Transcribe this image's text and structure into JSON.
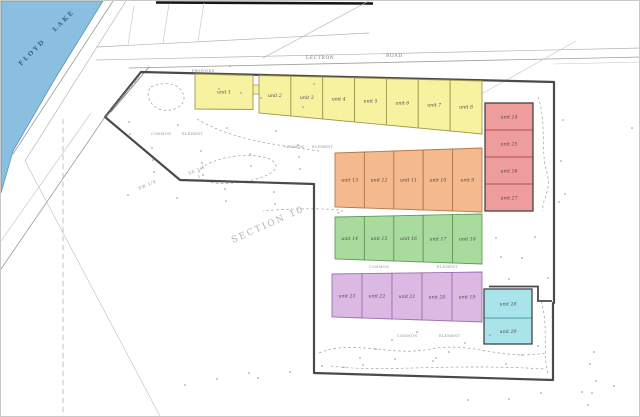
{
  "drawing": {
    "lake": {
      "label": "FLOYD LAKE",
      "color": "#8abfe0"
    },
    "roads": {
      "lectron": "LECTRON",
      "road": "ROAD",
      "proposed": "PROPOSED",
      "right_of_way": "PROPOSED RIGHT OF WAY"
    },
    "annotations": {
      "section": "SECTION 10",
      "se_quarter": "SE 1/4",
      "sw_quarter": "SW 1/4",
      "common": "COMMON",
      "element": "ELEMENT"
    },
    "lot_groups": [
      {
        "name": "yellow-row",
        "fill": "#f6f2a0",
        "stroke": "#a09a50",
        "units": [
          "unit 1",
          "unit 2",
          "unit 3",
          "unit 4",
          "unit 5",
          "unit 6",
          "unit 7",
          "unit 8"
        ]
      },
      {
        "name": "orange-row",
        "fill": "#f4b98d",
        "stroke": "#b5794a",
        "units": [
          "unit 13",
          "unit 12",
          "unit 11",
          "unit 10",
          "unit 9"
        ]
      },
      {
        "name": "green-row",
        "fill": "#a9db9f",
        "stroke": "#639a58",
        "units": [
          "unit 14",
          "unit 15",
          "unit 16",
          "unit 17",
          "unit 18"
        ]
      },
      {
        "name": "purple-row",
        "fill": "#dcb9e3",
        "stroke": "#9c6fae",
        "units": [
          "unit 23",
          "unit 22",
          "unit 21",
          "unit 20",
          "unit 19"
        ]
      },
      {
        "name": "red-column",
        "fill": "#ef9c9c",
        "stroke": "#a85454",
        "units": [
          "unit 24",
          "unit 25",
          "unit 26",
          "unit 27"
        ]
      },
      {
        "name": "cyan-column",
        "fill": "#a9e4ea",
        "stroke": "#4d9aa8",
        "units": [
          "unit 28",
          "unit 29"
        ]
      }
    ]
  }
}
